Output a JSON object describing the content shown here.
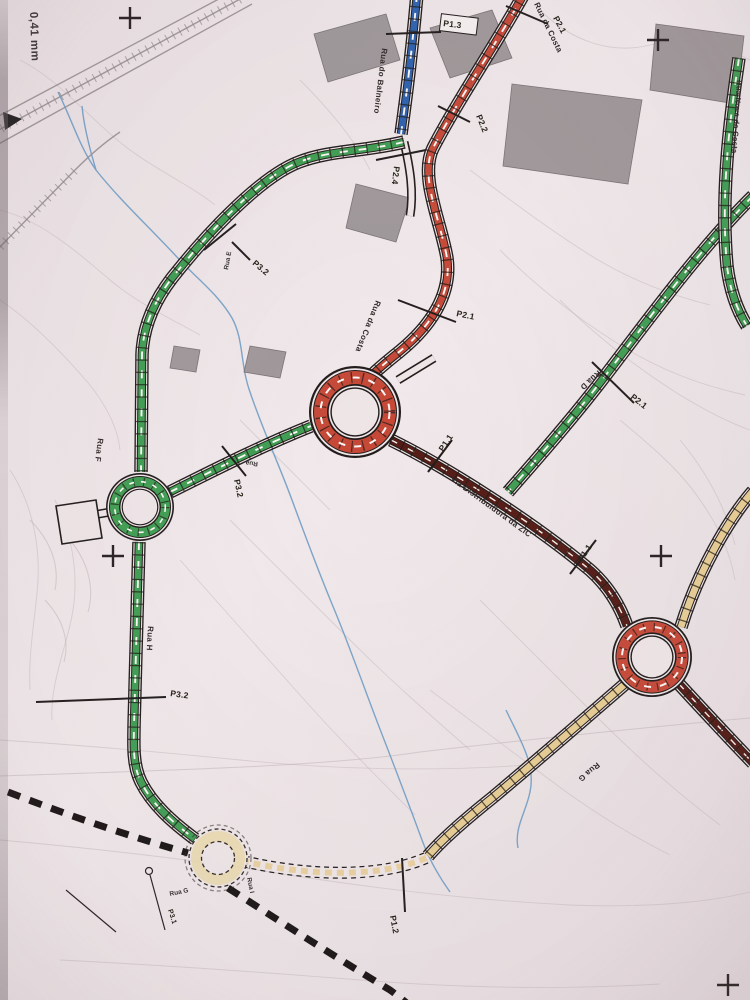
{
  "document": {
    "type": "scanned road network plan",
    "corner_note": "0,41 mm"
  },
  "colors": {
    "paper": "#eee5e7",
    "ink": "#231d1b",
    "road_green": "#3f9d52",
    "road_red": "#c64a38",
    "road_blue": "#2f62ae",
    "road_maroon": "#571e18",
    "road_tan": "#e7cc93",
    "stream": "#6f9cc4",
    "building": "#9a9395",
    "contour": "#c6babd"
  },
  "roads": {
    "balneiro": "Rua do Balneiro",
    "costa": "Rua da Costa",
    "nova": "Rua Nova da Costa",
    "d": "Rua D",
    "e": "Rua E",
    "f": "Rua F",
    "g": "Rua G",
    "h": "Rua H",
    "i": "Rua I",
    "rua": "Rua",
    "via": "Via Distribuidora da ZIC"
  },
  "sections": {
    "p11": "P1.1",
    "p12": "P1.2",
    "p13": "P1.3",
    "p21": "P2.1",
    "p22": "P2.2",
    "p24": "P2.4",
    "p31": "P3.1",
    "p32": "P3.2"
  }
}
